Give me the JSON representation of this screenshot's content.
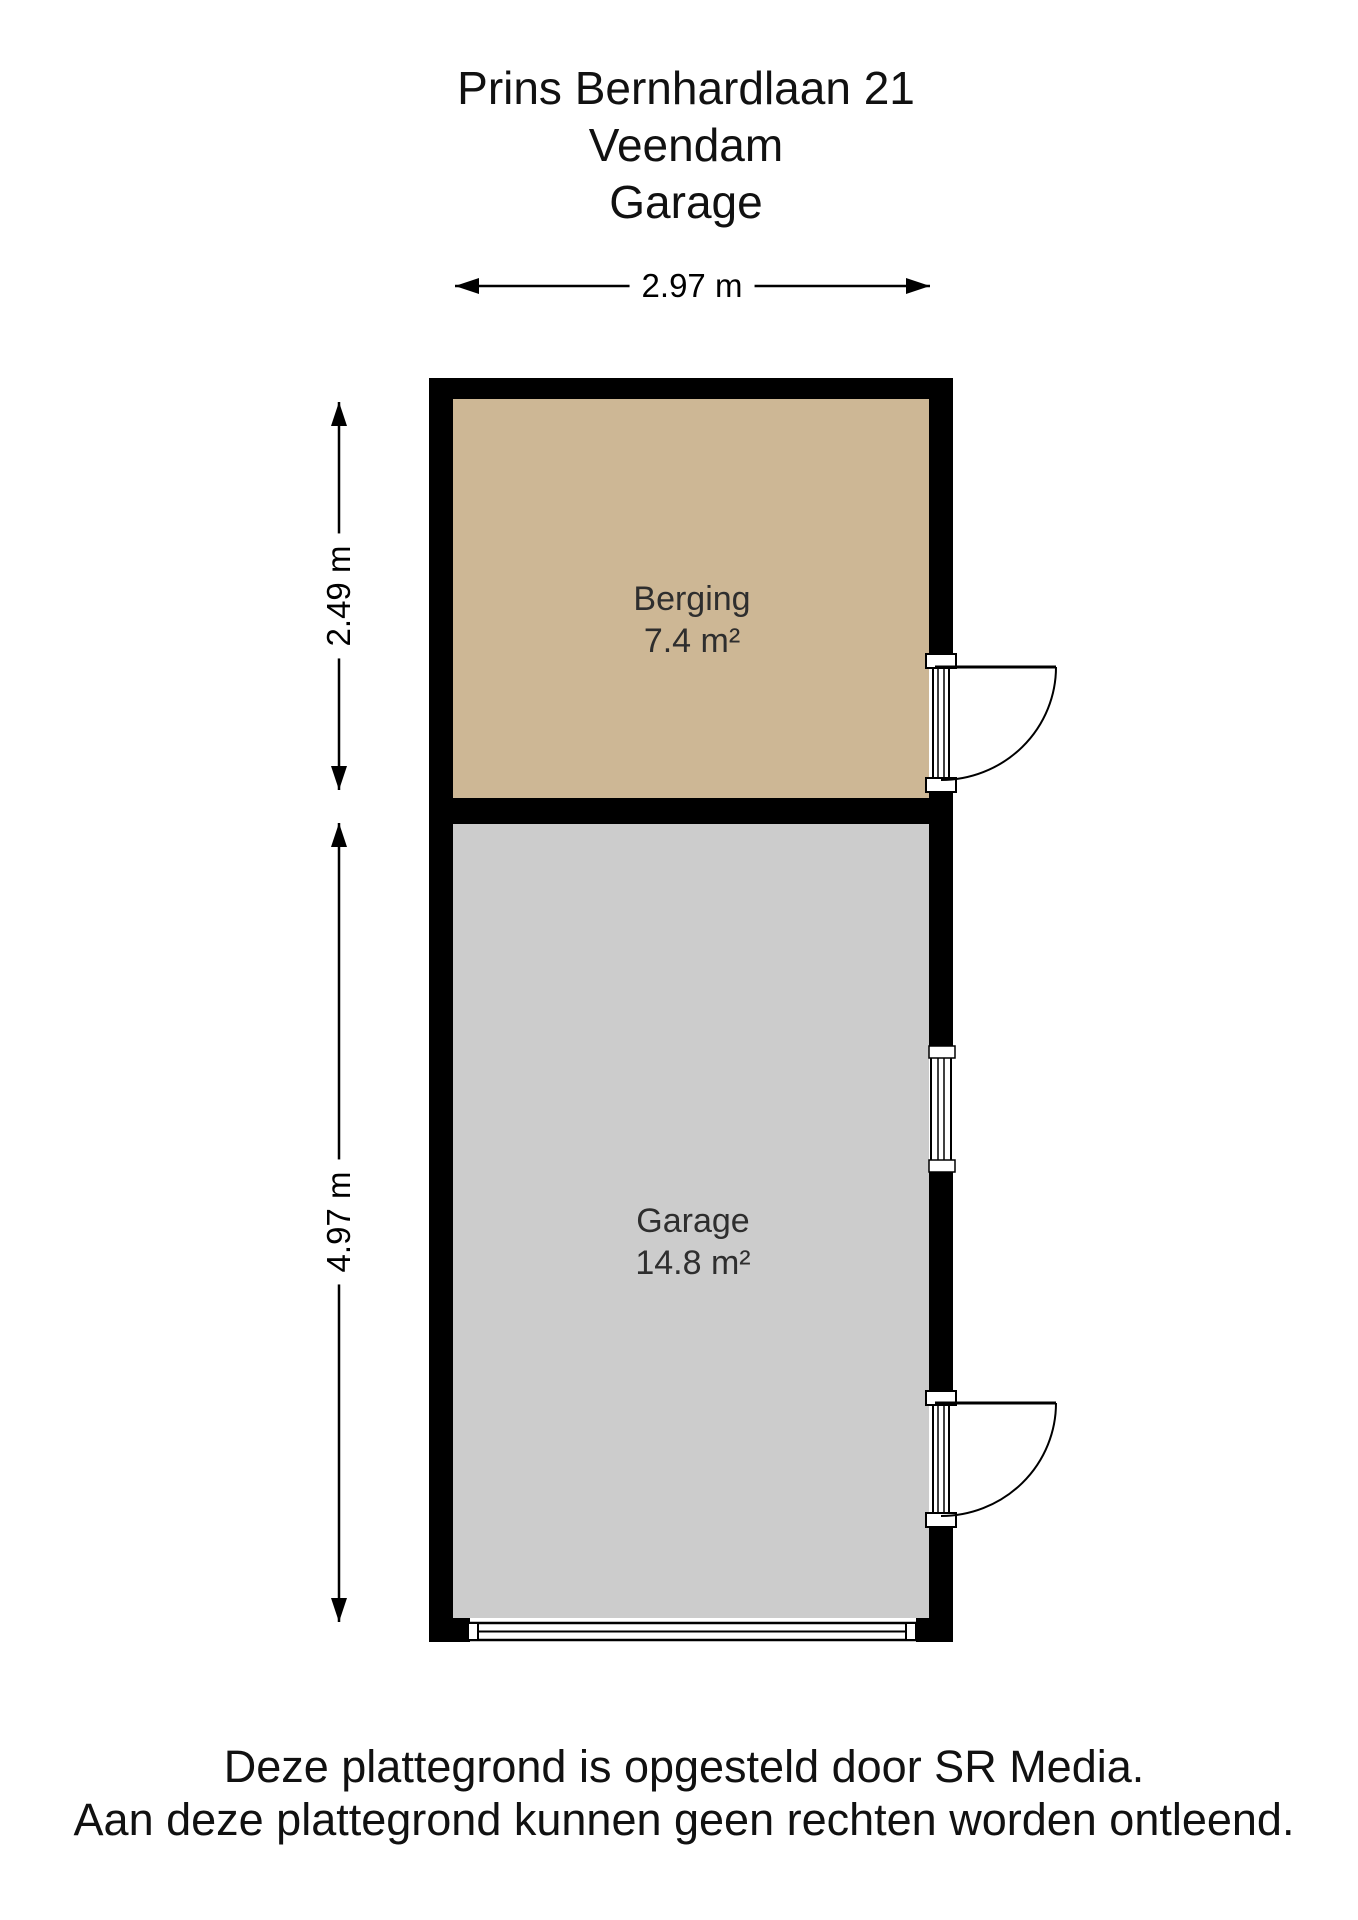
{
  "title": {
    "line1": "Prins Bernhardlaan 21",
    "line2": "Veendam",
    "line3": "Garage"
  },
  "dimensions": {
    "plan_width": "2.97 m",
    "berging_height": "2.49 m",
    "garage_height": "4.97 m"
  },
  "rooms": [
    {
      "name": "Berging",
      "area": "7.4 m²",
      "fill": "#cdb795"
    },
    {
      "name": "Garage",
      "area": "14.8 m²",
      "fill": "#cccccc"
    }
  ],
  "colors": {
    "wall": "#000000",
    "line": "#000000",
    "background": "#ffffff"
  },
  "footer": {
    "line1": "Deze plattegrond is opgesteld door SR Media.",
    "line2": "Aan deze plattegrond kunnen geen rechten worden ontleend."
  }
}
